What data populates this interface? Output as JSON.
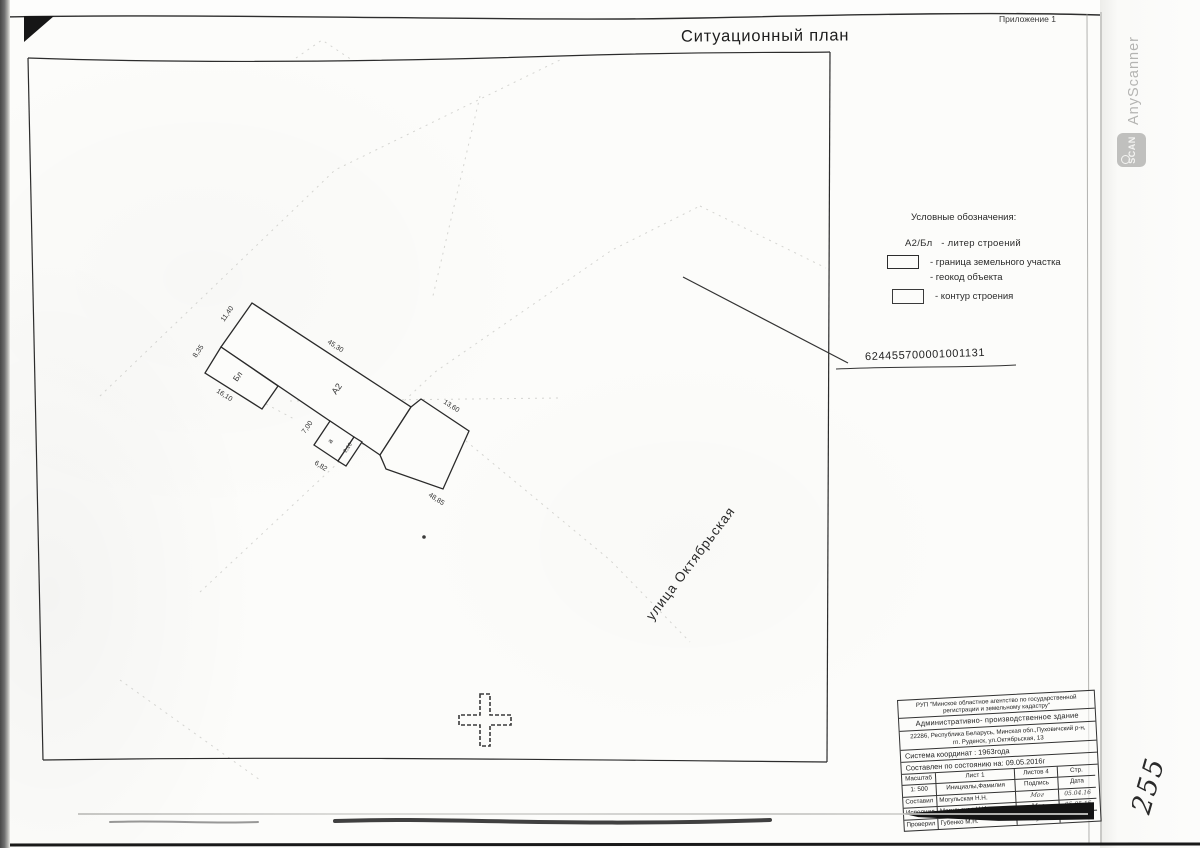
{
  "page": {
    "title": "Ситуационный план",
    "annex": "Приложение 1",
    "page_number": "255",
    "cadastral_number": "624455700001001131",
    "street": "улица Октябрьская"
  },
  "watermark": {
    "name": "AnyScanner",
    "logo": "SCAN"
  },
  "legend": {
    "title": "Условные обозначения:",
    "liter_symbol": "А2/Бл",
    "liter_label": "-  литер строений",
    "boundary_label": "-  граница земельного участка",
    "geocode_label": "-  геокод объекта",
    "contour_label": "-  контур строения"
  },
  "building": {
    "label_bl": "Бл",
    "label_a2": "А2",
    "label_a": "а",
    "dim_1140": "11,40",
    "dim_835": "8,35",
    "dim_1610": "16,10",
    "dim_4530": "45,30",
    "dim_1360": "13,60",
    "dim_700": "7,00",
    "dim_682": "6,82",
    "dim_210": "2,10",
    "dim_4885": "48,85"
  },
  "title_block": {
    "org_line1": "РУП \"Минское областное агентство по государственной",
    "org_line2": "регистрации и земельному кадастру\"",
    "object_name": "Административно- производственное здание",
    "address_line1": "22286, Республика Беларусь, Минская обл.,Пуховичский р-н,",
    "address_line2": "гп. Руденск, ул.Октябрьская, 13",
    "coord_system": "Система координат : 1963года",
    "compiled": "Составлен по состоянию на: 09.05.2016г",
    "scale_label": "Масштаб",
    "sheet_label": "Лист   1",
    "sheets_label": "Листов  4",
    "page_label": "Стр.",
    "scale_value": "1: 500",
    "name_header": "Инициалы,Фамилия",
    "sign_header": "Подпись",
    "date_header": "Дата",
    "rows": [
      {
        "role": "Составил",
        "name": "Могульская Н.Н.",
        "sign": "Мог",
        "date": "05.04.16"
      },
      {
        "role": "Исполнил",
        "name": "Могульская Н.И.",
        "sign": "Мог",
        "date": "05.05.16"
      },
      {
        "role": "Проверил",
        "name": "Губенко М.Н.",
        "sign": "Губ",
        "date": "10.05.16"
      }
    ]
  }
}
